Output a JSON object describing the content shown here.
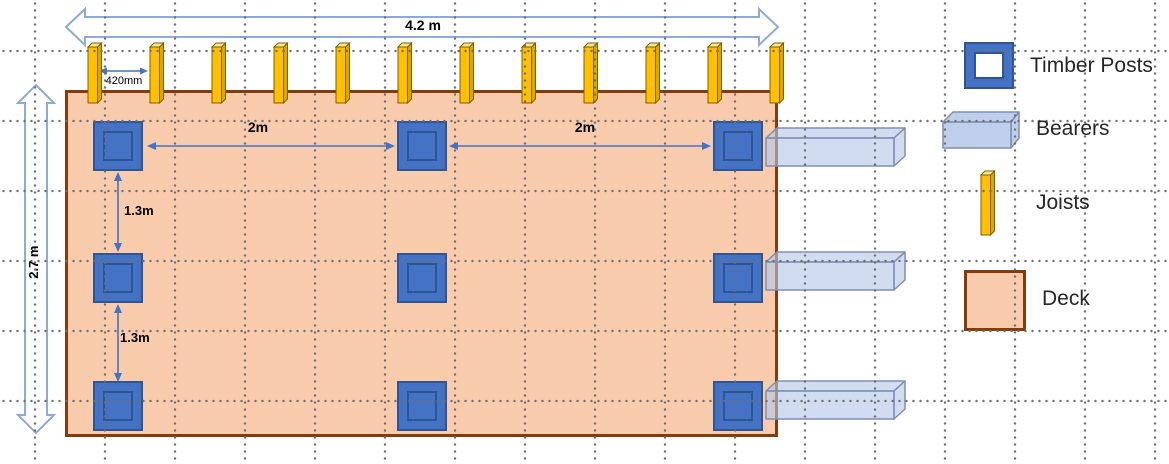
{
  "diagram": {
    "dimensions": {
      "deck_width": "4.2 m",
      "deck_depth": "2.7 m",
      "joist_spacing": "420mm",
      "post_gap_left": "2m",
      "post_gap_right": "2m",
      "post_gap_upper": "1.3m",
      "post_gap_lower": "1.3m"
    },
    "counts": {
      "joists": 12,
      "post_rows": 3,
      "post_cols": 3,
      "bearers": 3
    },
    "colors": {
      "deck_fill": "#F8CBAD",
      "deck_border": "#843C0C",
      "post_fill": "#4472C4",
      "post_border": "#2E5693",
      "joist_fill": "#FFC000",
      "joist_top": "#FFE699",
      "joist_border": "#7F6000",
      "bearer_fill": "#B4C7E7",
      "bearer_border": "#7E8FB2",
      "dimension_arrow": "#4472C4",
      "block_arrow_outline": "#8EAADB"
    }
  },
  "legend": {
    "items": [
      {
        "id": "timber-posts",
        "label": "Timber Posts"
      },
      {
        "id": "bearers",
        "label": "Bearers"
      },
      {
        "id": "joists",
        "label": "Joists"
      },
      {
        "id": "deck",
        "label": "Deck"
      }
    ]
  }
}
